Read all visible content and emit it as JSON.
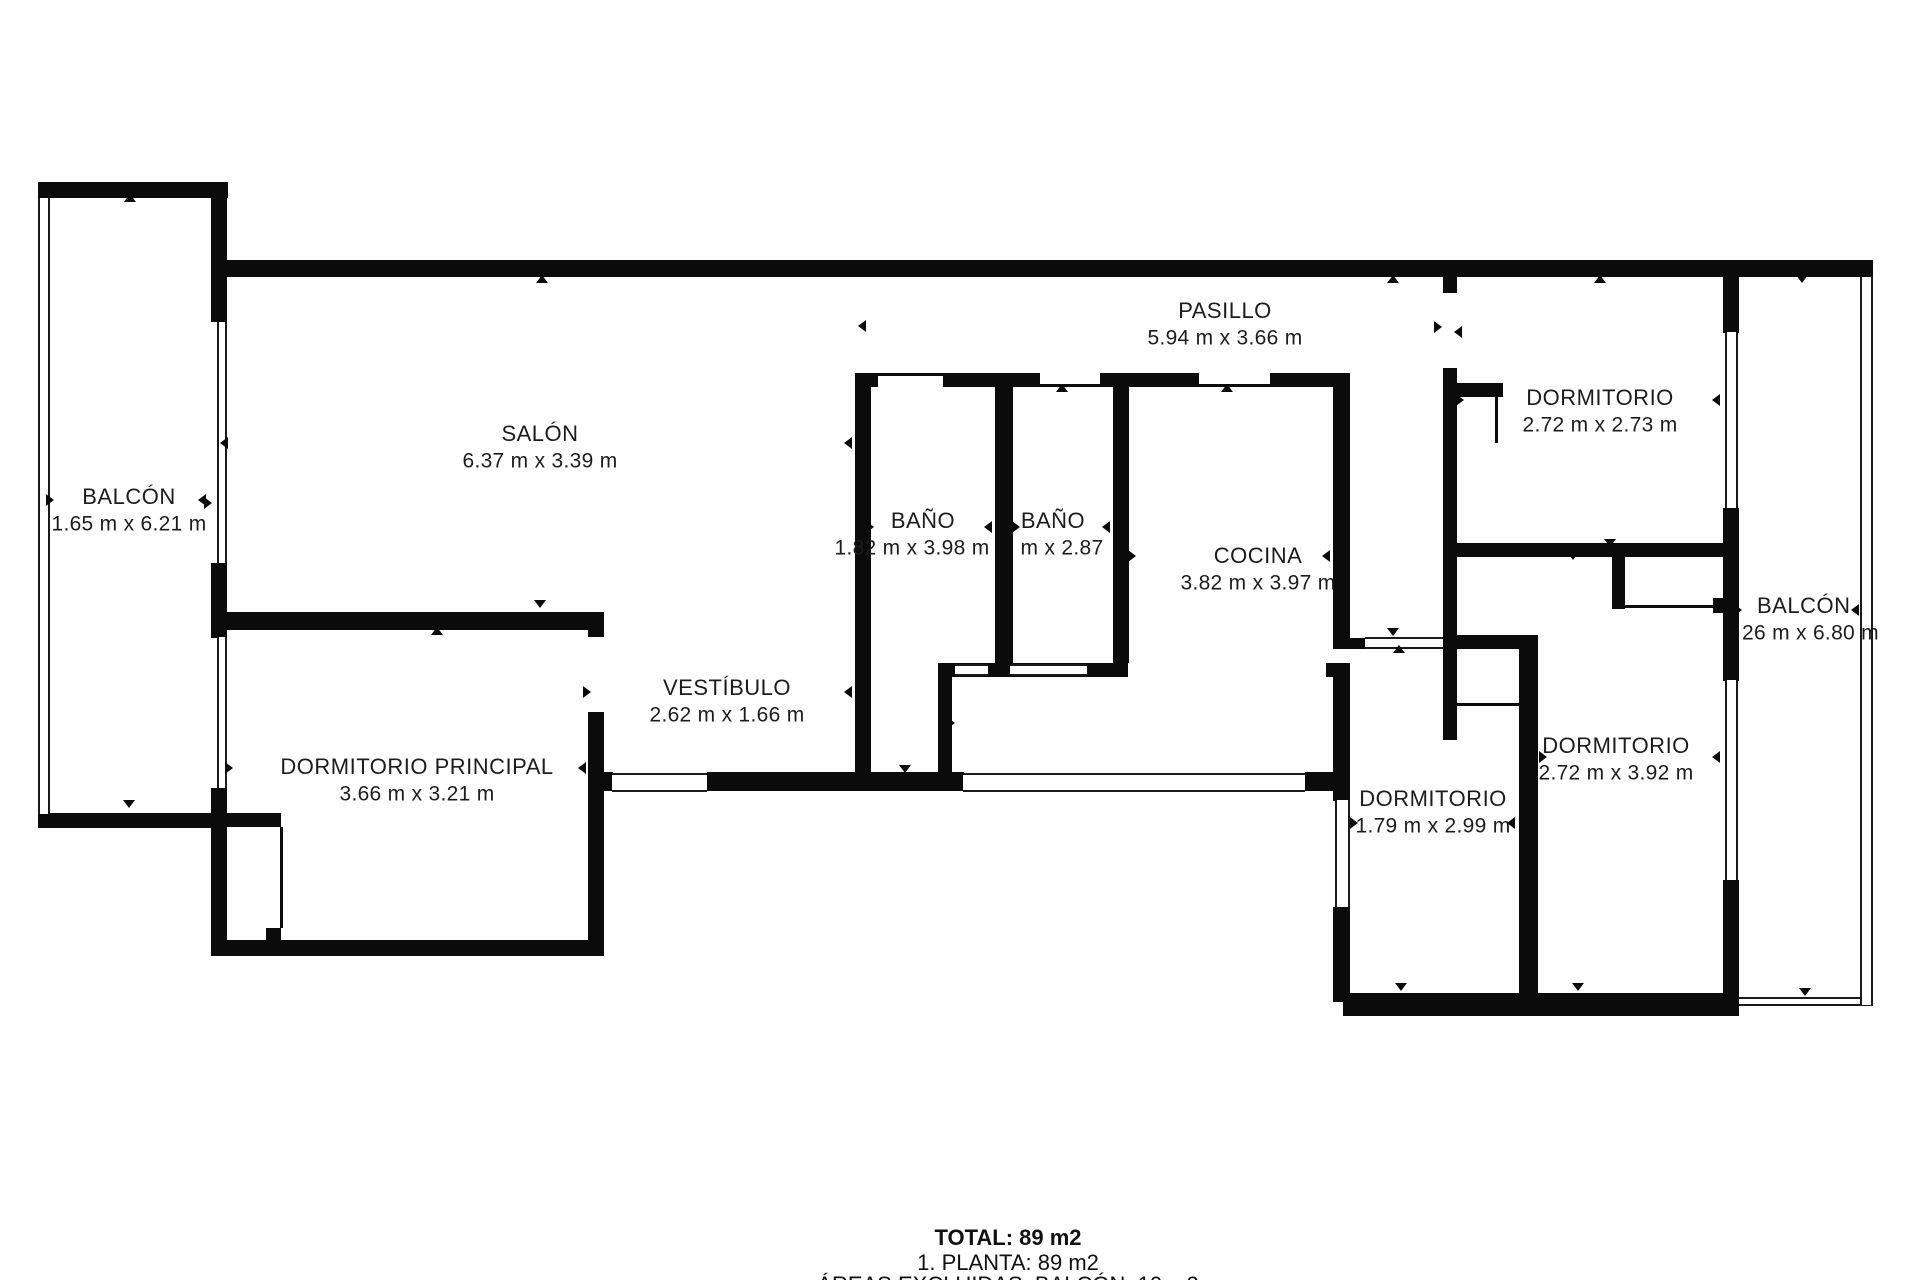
{
  "title_block": {
    "total": "TOTAL: 89 m2",
    "planta": "1. PLANTA: 89 m2",
    "areas_excluidas": "ÁREAS EXCLUIDAS: BALCÓN: 10 m2"
  },
  "plan": {
    "wall_color": "#0b0b0b",
    "rooms": [
      {
        "id": "balcon-izq",
        "name": "BALCÓN",
        "dims": "1.65 m x 6.21 m",
        "x": 129,
        "y": 497
      },
      {
        "id": "salon",
        "name": "SALÓN",
        "dims": "6.37 m x 3.39 m",
        "x": 540,
        "y": 434
      },
      {
        "id": "pasillo",
        "name": "PASILLO",
        "dims": "5.94 m x 3.66 m",
        "x": 1225,
        "y": 311
      },
      {
        "id": "dormitorio-superior",
        "name": "DORMITORIO",
        "dims": "2.72 m x 2.73 m",
        "x": 1600,
        "y": 398
      },
      {
        "id": "bano-1",
        "name": "BAÑO",
        "dims": "1.82 m x 3.98 m",
        "x": 923,
        "y": 521,
        "dims_x": 912
      },
      {
        "id": "bano-2",
        "name": "BAÑO",
        "dims": "m x 2.87",
        "x": 1053,
        "y": 521,
        "dims_x": 1062
      },
      {
        "id": "cocina",
        "name": "COCINA",
        "dims": "3.82 m x 3.97 m",
        "x": 1258,
        "y": 556
      },
      {
        "id": "vestibulo",
        "name": "VESTÍBULO",
        "dims": "2.62 m x 1.66 m",
        "x": 727,
        "y": 688
      },
      {
        "id": "dormitorio-principal",
        "name": "DORMITORIO PRINCIPAL",
        "dims": "3.66 m x 3.21 m",
        "x": 417,
        "y": 767
      },
      {
        "id": "dormitorio-2",
        "name": "DORMITORIO",
        "dims": "1.79 m x 2.99 m",
        "x": 1433,
        "y": 799
      },
      {
        "id": "dormitorio-3",
        "name": "DORMITORIO",
        "dims": "2.72 m x 3.92 m",
        "x": 1616,
        "y": 746
      },
      {
        "id": "balcon-der",
        "name": "BALCÓN",
        "dims": "26 m x 6.80 m",
        "x": 1757,
        "y": 606,
        "dims_x": 1742,
        "align": "left"
      }
    ],
    "walls": [
      [
        38,
        182,
        190,
        16
      ],
      [
        211,
        182,
        16,
        140
      ],
      [
        227,
        260,
        1646,
        17
      ],
      [
        211,
        563,
        16,
        75
      ],
      [
        211,
        788,
        16,
        167
      ],
      [
        38,
        813,
        176,
        15
      ],
      [
        211,
        940,
        393,
        16
      ],
      [
        227,
        612,
        374,
        18
      ],
      [
        588,
        612,
        16,
        25
      ],
      [
        588,
        712,
        16,
        244
      ],
      [
        603,
        772,
        10,
        19
      ],
      [
        707,
        772,
        257,
        19
      ],
      [
        1305,
        772,
        30,
        19
      ],
      [
        855,
        373,
        16,
        400
      ],
      [
        855,
        373,
        23,
        14
      ],
      [
        943,
        373,
        97,
        14
      ],
      [
        1100,
        373,
        99,
        14
      ],
      [
        1270,
        373,
        71,
        14
      ],
      [
        995,
        387,
        18,
        276
      ],
      [
        1113,
        387,
        16,
        276
      ],
      [
        938,
        663,
        58,
        14
      ],
      [
        995,
        663,
        133,
        14
      ],
      [
        938,
        677,
        14,
        96
      ],
      [
        1333,
        373,
        17,
        276
      ],
      [
        1348,
        638,
        18,
        11
      ],
      [
        1333,
        663,
        17,
        138
      ],
      [
        1333,
        907,
        17,
        95
      ],
      [
        1326,
        663,
        8,
        14
      ],
      [
        1443,
        277,
        14,
        16
      ],
      [
        1443,
        368,
        14,
        372
      ],
      [
        1457,
        383,
        46,
        14
      ],
      [
        1457,
        543,
        270,
        14
      ],
      [
        1457,
        635,
        81,
        14
      ],
      [
        1519,
        635,
        19,
        358
      ],
      [
        1612,
        557,
        13,
        52
      ],
      [
        1713,
        598,
        11,
        15
      ],
      [
        1723,
        277,
        16,
        56
      ],
      [
        1723,
        508,
        16,
        173
      ],
      [
        1723,
        880,
        16,
        136
      ],
      [
        1343,
        993,
        384,
        23
      ],
      [
        227,
        813,
        54,
        14
      ],
      [
        266,
        928,
        15,
        14
      ]
    ],
    "windows": [
      [
        612,
        773,
        95,
        19,
        "h"
      ],
      [
        963,
        773,
        342,
        19,
        "h"
      ],
      [
        955,
        664,
        33,
        12,
        "h"
      ],
      [
        1010,
        664,
        77,
        12,
        "h"
      ],
      [
        1365,
        637,
        78,
        12,
        "h"
      ],
      [
        1739,
        997,
        134,
        9,
        "h"
      ],
      [
        38,
        198,
        12,
        616,
        "v"
      ],
      [
        217,
        322,
        10,
        241,
        "v"
      ],
      [
        217,
        637,
        10,
        151,
        "v"
      ],
      [
        1335,
        800,
        15,
        107,
        "v"
      ],
      [
        1725,
        332,
        13,
        176,
        "v"
      ],
      [
        1725,
        680,
        13,
        200,
        "v"
      ],
      [
        1860,
        277,
        13,
        728,
        "v"
      ]
    ],
    "thin_lines": [
      [
        280,
        827,
        3,
        101
      ],
      [
        877,
        373,
        66,
        3
      ],
      [
        1040,
        384,
        60,
        3
      ],
      [
        1198,
        384,
        72,
        3
      ],
      [
        1457,
        703,
        62,
        3
      ],
      [
        1625,
        605,
        88,
        3
      ],
      [
        1495,
        397,
        3,
        46
      ]
    ],
    "ticks": [
      [
        130,
        200,
        "up"
      ],
      [
        542,
        281,
        "up"
      ],
      [
        1393,
        281,
        "up"
      ],
      [
        1600,
        281,
        "up"
      ],
      [
        1802,
        281,
        "down"
      ],
      [
        52,
        500,
        "right"
      ],
      [
        204,
        500,
        "left"
      ],
      [
        226,
        443,
        "left"
      ],
      [
        210,
        503,
        "right"
      ],
      [
        850,
        443,
        "left"
      ],
      [
        864,
        326,
        "left"
      ],
      [
        540,
        606,
        "down"
      ],
      [
        437,
        633,
        "up"
      ],
      [
        589,
        692,
        "right"
      ],
      [
        850,
        692,
        "left"
      ],
      [
        231,
        768,
        "right"
      ],
      [
        584,
        768,
        "left"
      ],
      [
        905,
        771,
        "down"
      ],
      [
        953,
        723,
        "right"
      ],
      [
        872,
        527,
        "right"
      ],
      [
        990,
        527,
        "left"
      ],
      [
        1018,
        527,
        "right"
      ],
      [
        1108,
        527,
        "left"
      ],
      [
        1134,
        556,
        "right"
      ],
      [
        1328,
        556,
        "left"
      ],
      [
        1062,
        390,
        "up"
      ],
      [
        1227,
        390,
        "up"
      ],
      [
        1440,
        327,
        "right"
      ],
      [
        1460,
        332,
        "left"
      ],
      [
        1393,
        634,
        "down"
      ],
      [
        1399,
        651,
        "up"
      ],
      [
        1462,
        400,
        "right"
      ],
      [
        1718,
        400,
        "left"
      ],
      [
        1573,
        558,
        "down"
      ],
      [
        1610,
        545,
        "down"
      ],
      [
        1356,
        823,
        "right"
      ],
      [
        1513,
        823,
        "left"
      ],
      [
        1545,
        757,
        "right"
      ],
      [
        1718,
        757,
        "left"
      ],
      [
        1740,
        610,
        "right"
      ],
      [
        1857,
        610,
        "left"
      ],
      [
        1401,
        989,
        "down"
      ],
      [
        1578,
        989,
        "down"
      ],
      [
        1805,
        994,
        "down"
      ],
      [
        129,
        806,
        "down"
      ]
    ]
  }
}
